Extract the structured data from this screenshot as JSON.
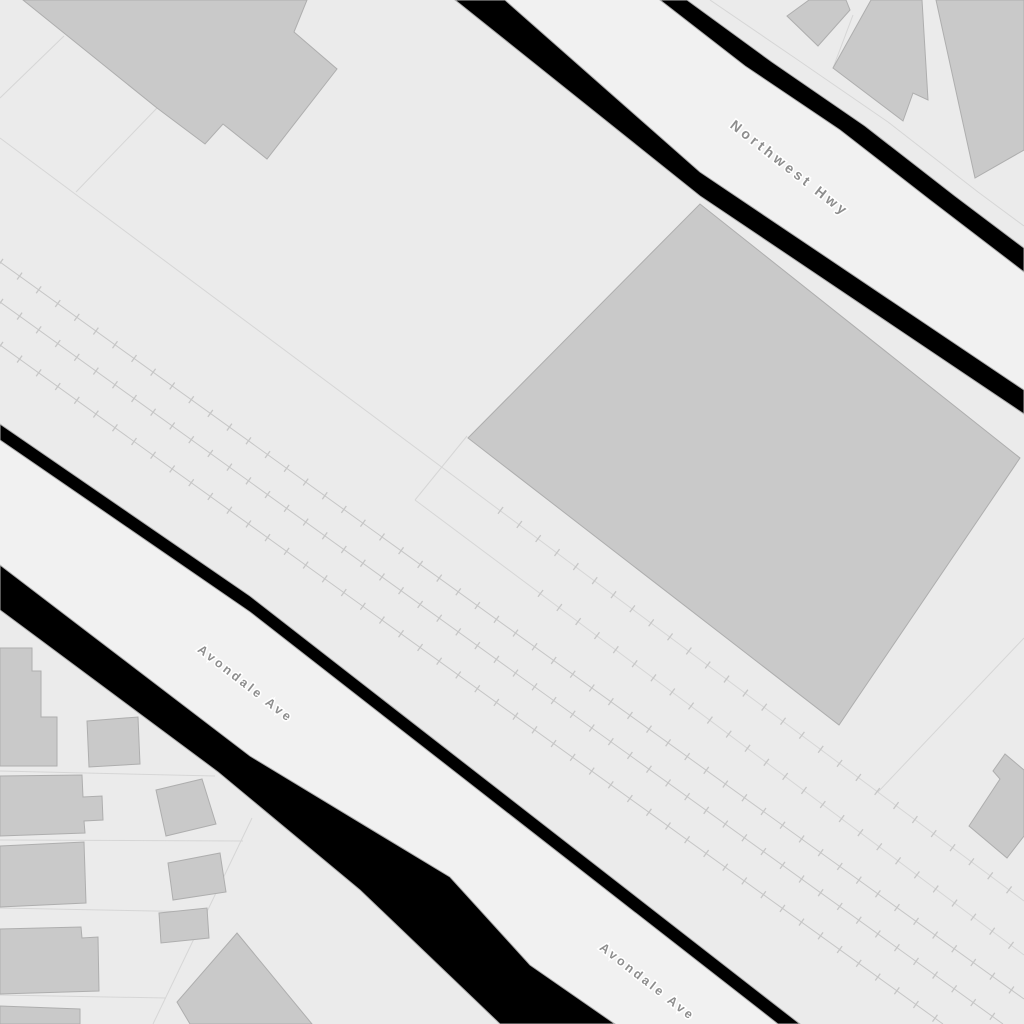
{
  "map": {
    "labels": {
      "northwest_hwy": "Northwest Hwy",
      "avondale_ave_west": "Avondale Ave",
      "avondale_ave_east": "Avondale Ave"
    },
    "colors": {
      "background": "#ebebeb",
      "road_surface": "#f1f1f1",
      "road_casing": "#000000",
      "casing_hairline": "#b0b0b0",
      "building_fill": "#c9c9c9",
      "building_stroke": "#aeaeae",
      "parcel_line": "#d6d6d6",
      "railway_line": "#c6c6c6",
      "label_text": "#8d8d8d",
      "label_halo": "#ffffff"
    }
  }
}
